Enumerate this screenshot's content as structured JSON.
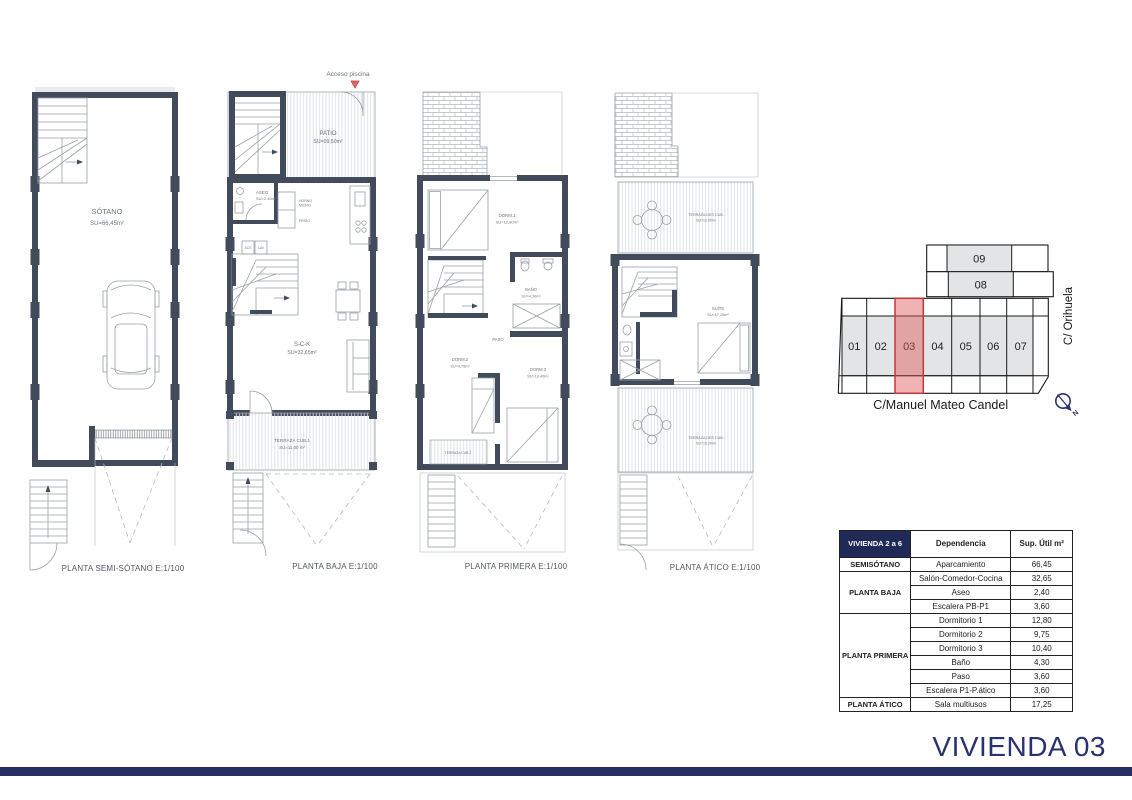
{
  "plans": {
    "semisotano": {
      "title": "PLANTA SEMI-SÓTANO  E:1/100",
      "room_name": "SÓTANO",
      "room_area": "SU=66,45m²"
    },
    "baja": {
      "title": "PLANTA BAJA  E:1/100",
      "acceso": "Acceso piscina",
      "patio_name": "PATIO",
      "patio_area": "SU=09,50m²",
      "aseo_name": "ASEO",
      "aseo_area": "SU=2,40m²",
      "horno": "HORNO",
      "micro": "MICRO",
      "frigo": "FRIGO",
      "acs": "ACS",
      "lav": "LAV",
      "sck_name": "S-C-K",
      "sck_area": "SU=32,65m²",
      "terraza_name": "TERRAZA CUB.1",
      "terraza_area": "SU=11,00 m²"
    },
    "primera": {
      "title": "PLANTA PRIMERA  E:1/100",
      "dorm1_name": "DORM.1",
      "dorm1_area": "SU=12,80m²",
      "bano_name": "BAÑO",
      "bano_area": "SU=4,30m²",
      "paso": "PASO",
      "dorm2_name": "DORM.2",
      "dorm2_area": "SU=9,75m²",
      "dorm3_name": "DORM.3",
      "dorm3_area": "SU=10,40m²",
      "terraza_name": "TERRAZA CUB.2"
    },
    "atico": {
      "title": "PLANTA ÁTICO  E:1/100",
      "terraza_top_name": "TERRAZA DES CUB.",
      "terraza_top_area": "SU=12,00m²",
      "suite_name": "SUITE",
      "suite_area": "SU=17,25m²",
      "terraza_bottom_name": "TERRAZA DES CUB.",
      "terraza_bottom_area": "SU=15,20m²"
    }
  },
  "site_plan": {
    "units": [
      "01",
      "02",
      "03",
      "04",
      "05",
      "06",
      "07"
    ],
    "upper_units": [
      "09",
      "08"
    ],
    "highlighted_unit": "03",
    "highlight_fill": "#e88a8a",
    "highlight_border": "#c03a3a",
    "street_right": "C/ Orihuela",
    "street_bottom": "C/Manuel Mateo Candel",
    "north": "N"
  },
  "table": {
    "header": [
      "VIVIENDA 2 a 6",
      "Dependencia",
      "Sup. Útil m²"
    ],
    "groups": [
      {
        "floor": "SEMISÓTANO",
        "rows": [
          {
            "room": "Aparcamiento",
            "area": "66,45"
          }
        ]
      },
      {
        "floor": "PLANTA BAJA",
        "rows": [
          {
            "room": "Salón-Comedor-Cocina",
            "area": "32,65"
          },
          {
            "room": "Aseo",
            "area": "2,40"
          },
          {
            "room": "Escalera PB-P1",
            "area": "3,60"
          }
        ]
      },
      {
        "floor": "PLANTA PRIMERA",
        "rows": [
          {
            "room": "Dormitorio 1",
            "area": "12,80"
          },
          {
            "room": "Dormitorio 2",
            "area": "9,75"
          },
          {
            "room": "Dormitorio 3",
            "area": "10,40"
          },
          {
            "room": "Baño",
            "area": "4,30"
          },
          {
            "room": "Paso",
            "area": "3,60"
          },
          {
            "room": "Escalera P1-P.ático",
            "area": "3,60"
          }
        ]
      },
      {
        "floor": "PLANTA ÁTICO",
        "rows": [
          {
            "room": "Sala multiusos",
            "area": "17,25"
          }
        ]
      }
    ]
  },
  "footer": {
    "title": "VIVIENDA 03"
  }
}
